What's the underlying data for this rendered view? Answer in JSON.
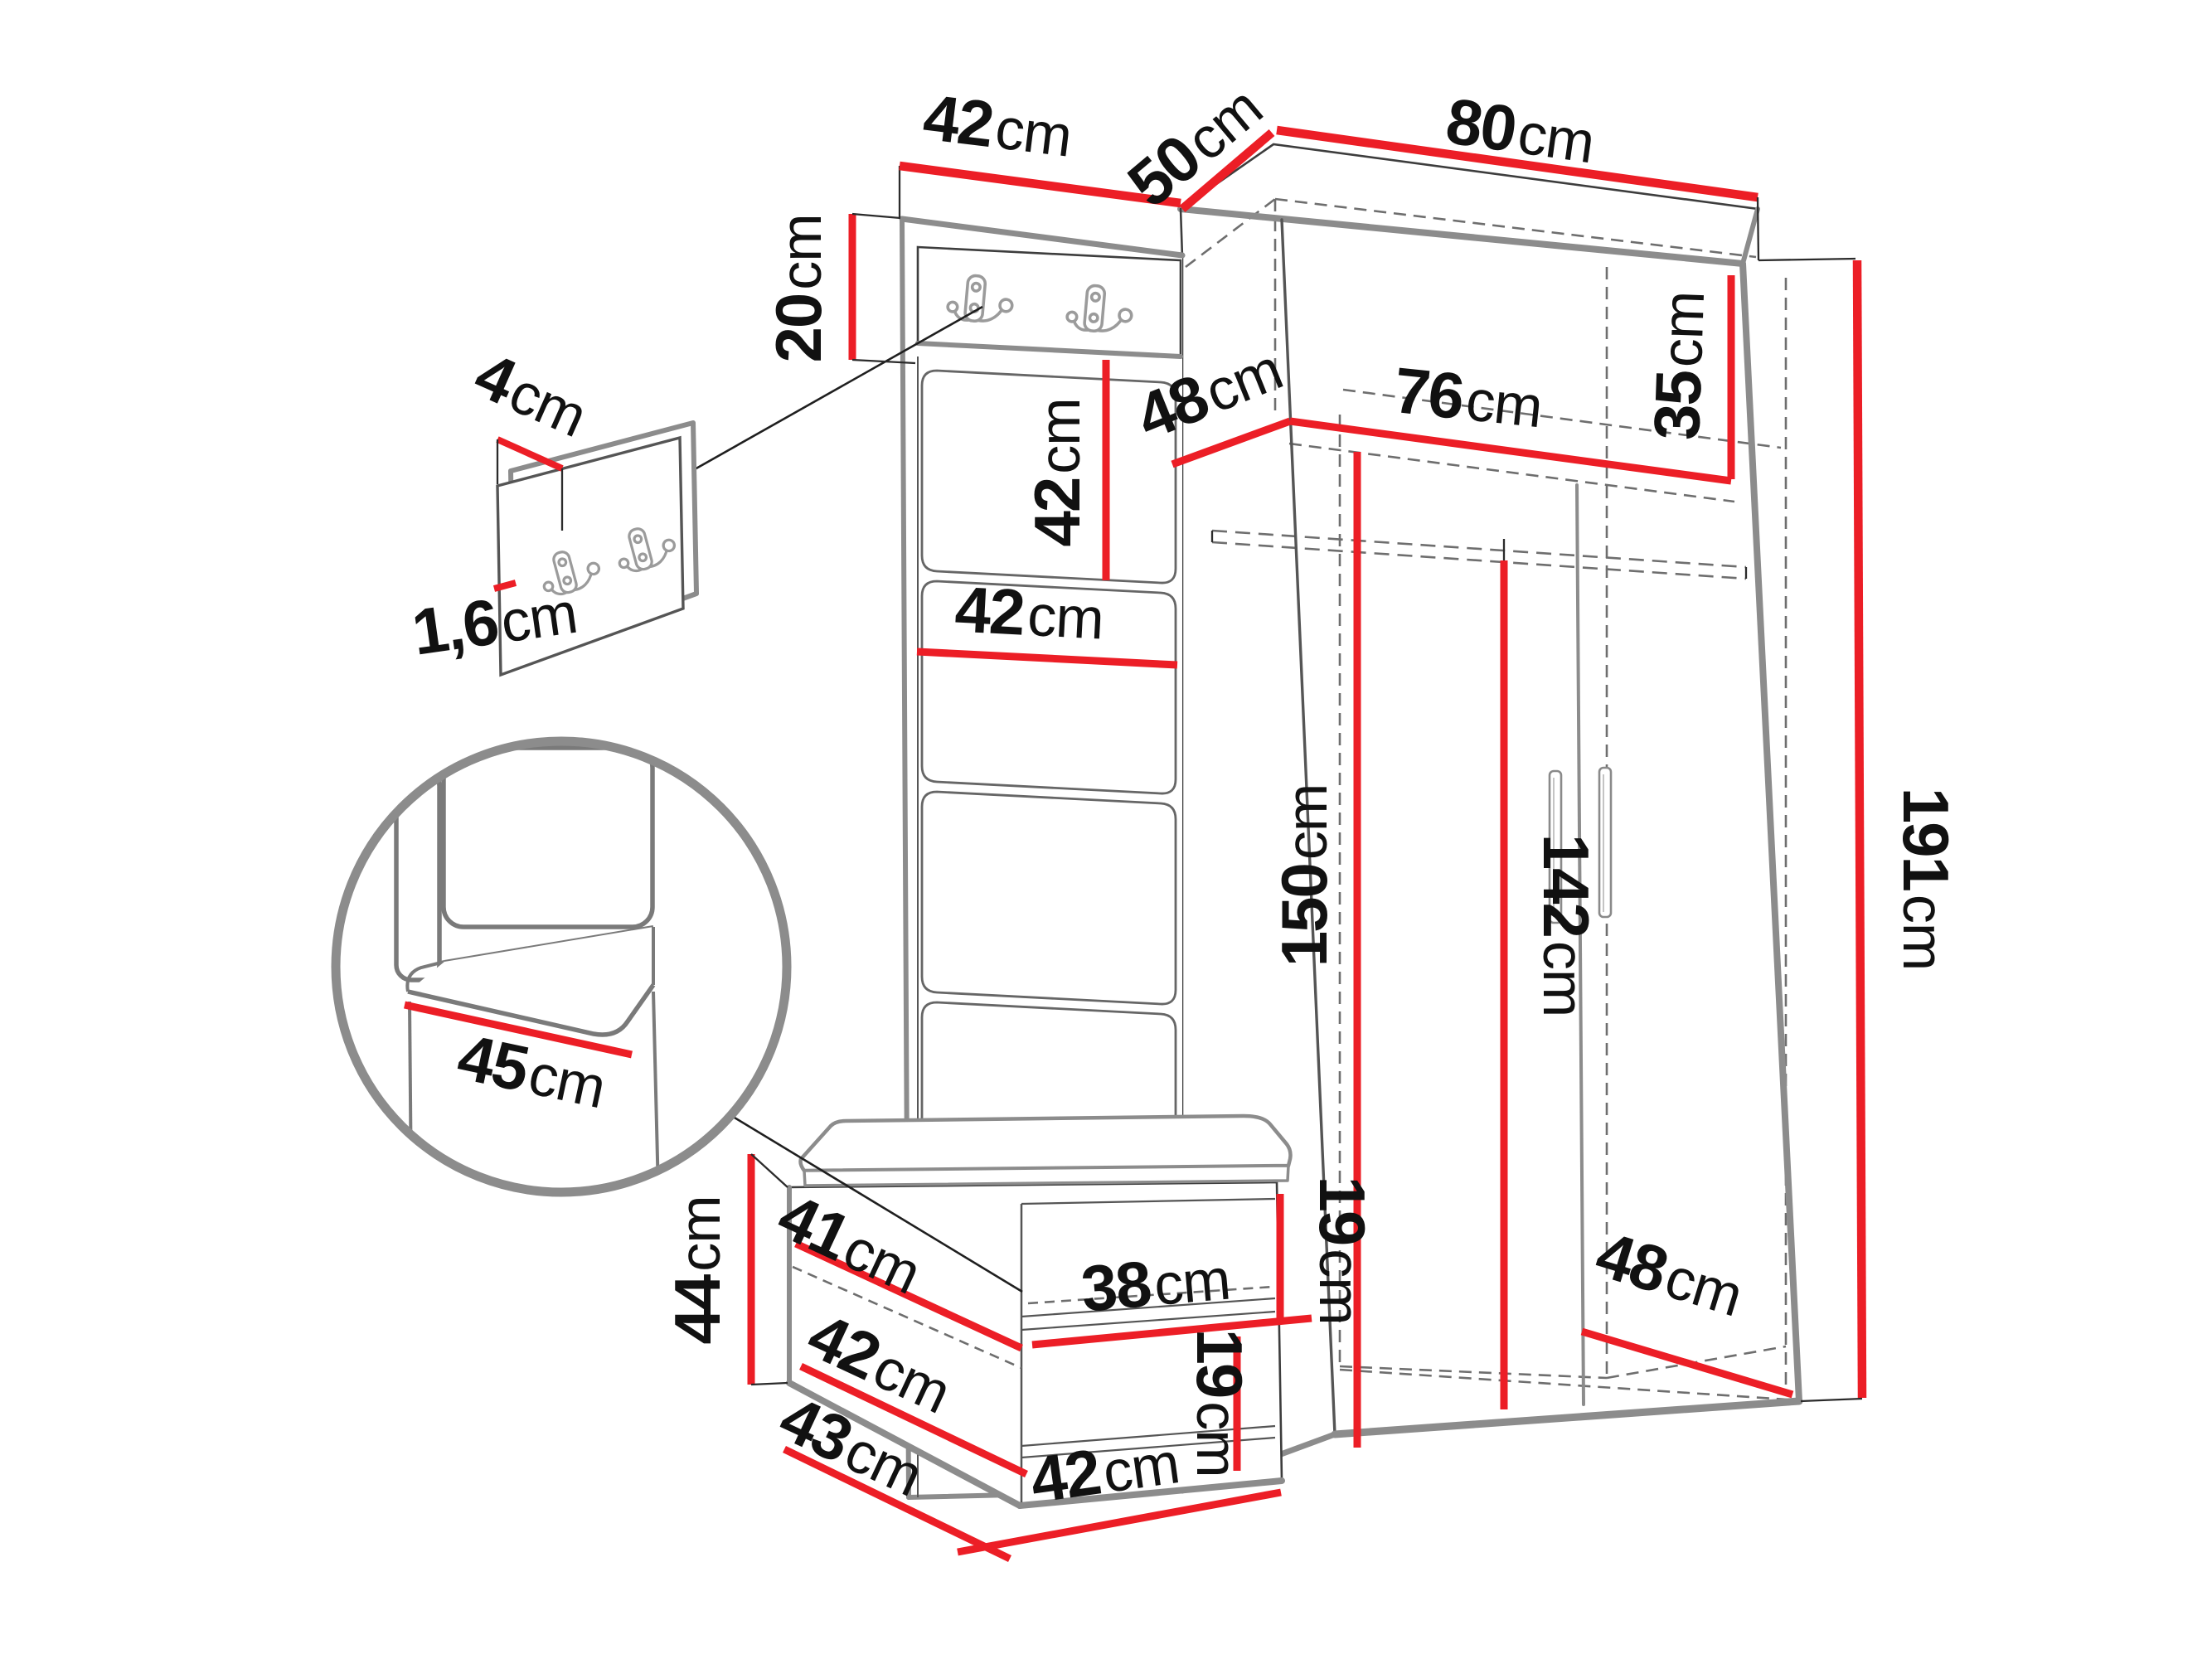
{
  "meta": {
    "diagram_type": "furniture-dimension-diagram",
    "subject": "hallway set: coat panel with hooks, corner wardrobe, shoe bench",
    "units": "cm",
    "accent_color": "#ec1e26",
    "edge_color": "#8c8c8c",
    "text_color": "#111111",
    "background_color": "#ffffff"
  },
  "icons": {
    "coat_hook": "double-coat-hook-icon",
    "hook_count_main_panel": 2,
    "hook_count_detail_panel": 2
  },
  "dims": {
    "top42": {
      "value": "42",
      "unit": "cm"
    },
    "side50": {
      "value": "50",
      "unit": "cm"
    },
    "width80": {
      "value": "80",
      "unit": "cm"
    },
    "board20": {
      "value": "20",
      "unit": "cm"
    },
    "detail4": {
      "value": "4",
      "unit": "cm"
    },
    "detail16": {
      "value": "1,6",
      "unit": "cm"
    },
    "shelf48": {
      "value": "48",
      "unit": "cm"
    },
    "shelf76": {
      "value": "76",
      "unit": "cm"
    },
    "shelf35": {
      "value": "35",
      "unit": "cm"
    },
    "panel42v": {
      "value": "42",
      "unit": "cm"
    },
    "panel42h": {
      "value": "42",
      "unit": "cm"
    },
    "inner150": {
      "value": "150",
      "unit": "cm"
    },
    "door142": {
      "value": "142",
      "unit": "cm"
    },
    "height191": {
      "value": "191",
      "unit": "cm"
    },
    "depth48": {
      "value": "48",
      "unit": "cm"
    },
    "seat45": {
      "value": "45",
      "unit": "cm"
    },
    "bench44": {
      "value": "44",
      "unit": "cm"
    },
    "bench41": {
      "value": "41",
      "unit": "cm"
    },
    "bench38": {
      "value": "38",
      "unit": "cm"
    },
    "gap19a": {
      "value": "19",
      "unit": "cm"
    },
    "gap19b": {
      "value": "19",
      "unit": "cm"
    },
    "bench42s": {
      "value": "42",
      "unit": "cm"
    },
    "bench43": {
      "value": "43",
      "unit": "cm"
    },
    "bench42b": {
      "value": "42",
      "unit": "cm"
    }
  }
}
